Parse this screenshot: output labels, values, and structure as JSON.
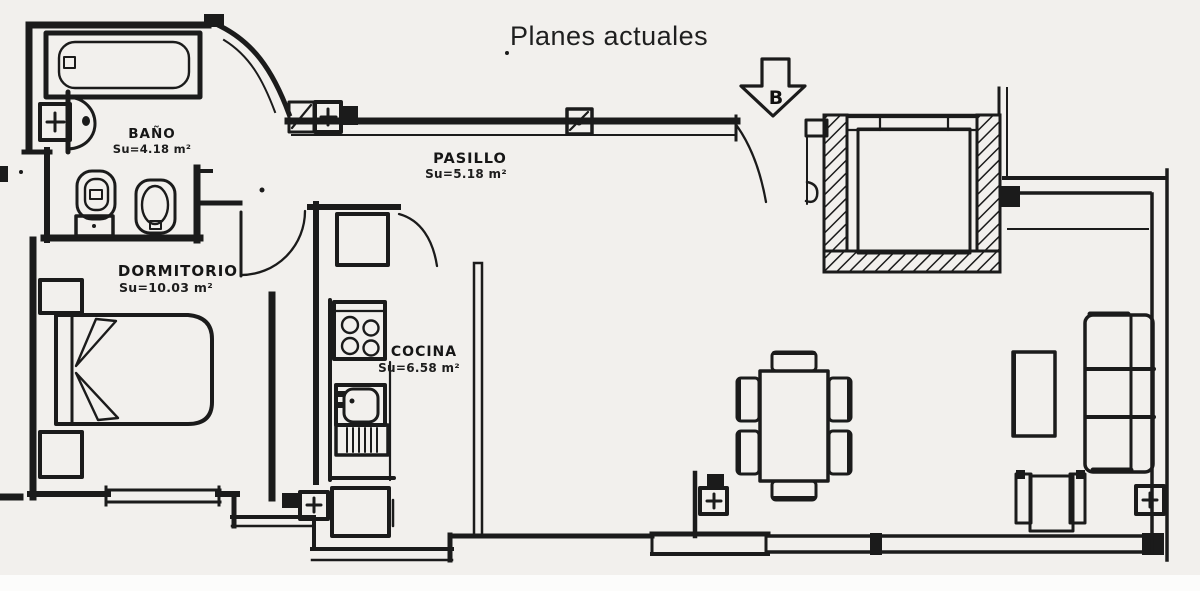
{
  "title": "Planes actuales",
  "compass": {
    "label": "B"
  },
  "rooms": {
    "bano": {
      "name": "BAÑO",
      "area": "Su=4.18 m²"
    },
    "pasillo": {
      "name": "PASILLO",
      "area": "Su=5.18 m²"
    },
    "dormitorio": {
      "name": "DORMITORIO",
      "area": "Su=10.03 m²"
    },
    "cocina": {
      "name": "COCINA",
      "area": "Su=6.58 m²"
    }
  },
  "colors": {
    "ink": "#1b1b1b",
    "paper": "#f2f0ed"
  }
}
